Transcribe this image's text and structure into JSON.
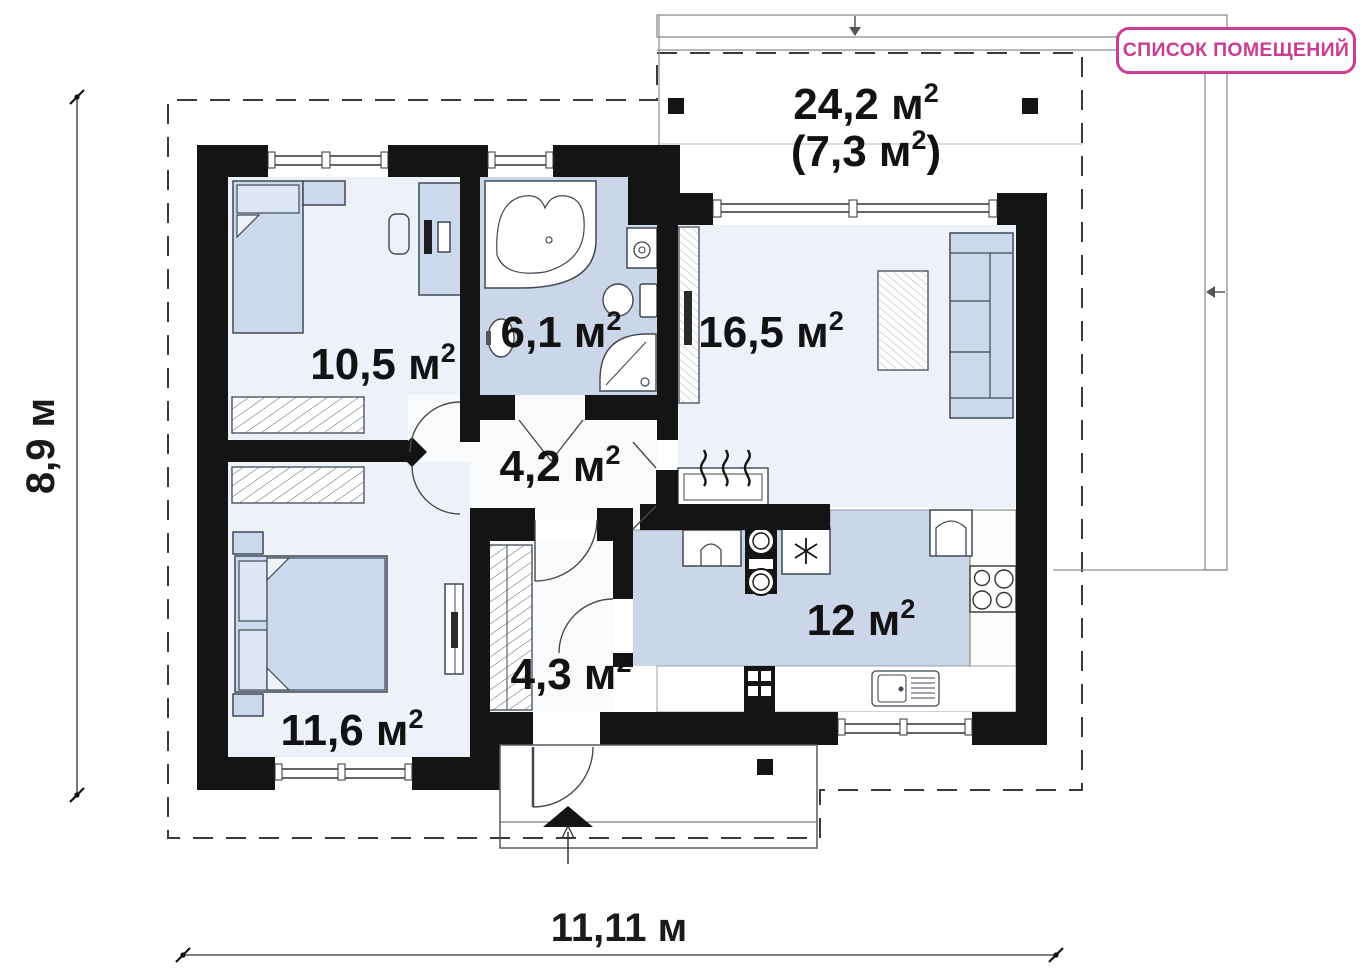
{
  "toolbar": {
    "rooms_list_button": "СПИСОК ПОМЕЩЕНИЙ"
  },
  "plan": {
    "rooms": [
      {
        "name": "terrace",
        "area": "24,2 м",
        "sup": "2",
        "secondary_pre": "(7,3 м",
        "secondary_sup": "2",
        "secondary_post": ")"
      },
      {
        "name": "bedroom-1",
        "area": "10,5 м",
        "sup": "2"
      },
      {
        "name": "bathroom",
        "area": "6,1 м",
        "sup": "2"
      },
      {
        "name": "living-room",
        "area": "16,5 м",
        "sup": "2"
      },
      {
        "name": "hallway",
        "area": "4,2 м",
        "sup": "2"
      },
      {
        "name": "entrance-hall",
        "area": "4,3 м",
        "sup": "2"
      },
      {
        "name": "kitchen",
        "area": "12 м",
        "sup": "2"
      },
      {
        "name": "bedroom-2",
        "area": "11,6 м",
        "sup": "2"
      }
    ],
    "dimensions": {
      "vertical": "8,9 м",
      "horizontal": "11,11 м"
    },
    "colors": {
      "accent": "#cb3d92",
      "walls": "#141414",
      "floor_light": "#edf2f8",
      "floor_wet": "#cbd7e9",
      "furniture": "#ccd9ec"
    }
  }
}
